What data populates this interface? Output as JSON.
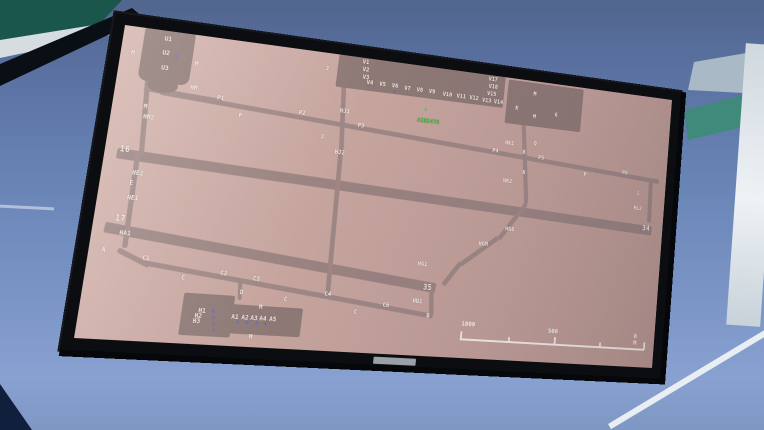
{
  "colors": {
    "screen_background": "#c3a19b",
    "pavement": "#9d8684",
    "apron": "#8d7875",
    "label_text": "#f2eae4",
    "aircraft_blue": "#4a66e8",
    "aircraft_green": "#3cc23c",
    "callsign_green": "#43bd3e",
    "bezel": "#0b0d10",
    "sky_top": "#51658d",
    "sky_bottom": "#88a1d1"
  },
  "display": {
    "kind": "airport ground chart",
    "callsign": "AIB2478",
    "scale_bar": {
      "start": "1000",
      "mid": "500",
      "end": "0 M"
    },
    "runways": [
      "16/34",
      "17/35"
    ],
    "labels": [
      {
        "t": "U1",
        "u": 40,
        "v": 6
      },
      {
        "t": "U2",
        "u": 40,
        "v": 20
      },
      {
        "t": "U3",
        "u": 41,
        "v": 35
      },
      {
        "t": "M",
        "u": 10,
        "v": 24
      },
      {
        "t": "M",
        "u": 73,
        "v": 27
      },
      {
        "t": "HM",
        "u": 72,
        "v": 51
      },
      {
        "t": "P1",
        "u": 100,
        "v": 58
      },
      {
        "t": "P",
        "u": 124,
        "v": 73
      },
      {
        "t": "M",
        "u": 30,
        "v": 75
      },
      {
        "t": "HM2",
        "u": 31,
        "v": 85
      },
      {
        "t": "16",
        "u": 14,
        "v": 117,
        "k": "r"
      },
      {
        "t": "HE2",
        "u": 29,
        "v": 140
      },
      {
        "t": "E",
        "u": 28,
        "v": 150
      },
      {
        "t": "NE1",
        "u": 28,
        "v": 164
      },
      {
        "t": "17",
        "u": 20,
        "v": 183,
        "k": "r"
      },
      {
        "t": "HA1",
        "u": 26,
        "v": 198
      },
      {
        "t": "A",
        "u": 12,
        "v": 215
      },
      {
        "t": "C1",
        "u": 51,
        "v": 220
      },
      {
        "t": "C",
        "u": 91,
        "v": 236
      },
      {
        "t": "C2",
        "u": 128,
        "v": 229
      },
      {
        "t": "C3",
        "u": 161,
        "v": 232
      },
      {
        "t": "D",
        "u": 150,
        "v": 246
      },
      {
        "t": "C",
        "u": 195,
        "v": 250
      },
      {
        "t": "M",
        "u": 171,
        "v": 259
      },
      {
        "t": "H1",
        "u": 112,
        "v": 266
      },
      {
        "t": "H2",
        "u": 109,
        "v": 271
      },
      {
        "t": "H3",
        "u": 108,
        "v": 276
      },
      {
        "t": "A1",
        "u": 145,
        "v": 270
      },
      {
        "t": "A2",
        "u": 155,
        "v": 270
      },
      {
        "t": "A3",
        "u": 164,
        "v": 270
      },
      {
        "t": "A4",
        "u": 173,
        "v": 270
      },
      {
        "t": "A5",
        "u": 183,
        "v": 270
      },
      {
        "t": "M",
        "u": 165,
        "v": 288
      },
      {
        "t": "C4",
        "u": 236,
        "v": 242
      },
      {
        "t": "C",
        "u": 269,
        "v": 258
      },
      {
        "t": "C6",
        "u": 299,
        "v": 249
      },
      {
        "t": "B",
        "u": 348,
        "v": 257
      },
      {
        "t": "HB1",
        "u": 331,
        "v": 243
      },
      {
        "t": "35",
        "u": 341,
        "v": 227,
        "k": "r"
      },
      {
        "t": "HG1",
        "u": 332,
        "v": 205
      },
      {
        "t": "HGM",
        "u": 398,
        "v": 179
      },
      {
        "t": "HG6",
        "u": 427,
        "v": 161
      },
      {
        "t": "HK2",
        "u": 419,
        "v": 110
      },
      {
        "t": "K",
        "u": 441,
        "v": 99
      },
      {
        "t": "P",
        "u": 515,
        "v": 94
      },
      {
        "t": "P6",
        "u": 563,
        "v": 87
      },
      {
        "t": "L",
        "u": 584,
        "v": 108
      },
      {
        "t": "HL2",
        "u": 581,
        "v": 125
      },
      {
        "t": "34",
        "u": 594,
        "v": 145,
        "k": "r"
      },
      {
        "t": "P5",
        "u": 458,
        "v": 81
      },
      {
        "t": "K",
        "u": 439,
        "v": 77
      },
      {
        "t": "HK1",
        "u": 417,
        "v": 69
      },
      {
        "t": "Q",
        "u": 451,
        "v": 66
      },
      {
        "t": "P4",
        "u": 403,
        "v": 79
      },
      {
        "t": "K",
        "u": 425,
        "v": 30
      },
      {
        "t": "M",
        "u": 445,
        "v": 12
      },
      {
        "t": "M",
        "u": 447,
        "v": 37
      },
      {
        "t": "G",
        "u": 473,
        "v": 32
      },
      {
        "t": "J",
        "u": 207,
        "v": 14
      },
      {
        "t": "HJ1",
        "u": 228,
        "v": 56
      },
      {
        "t": "P3",
        "u": 249,
        "v": 69
      },
      {
        "t": "J",
        "u": 211,
        "v": 85
      },
      {
        "t": "HJ2",
        "u": 228,
        "v": 99
      },
      {
        "t": "P2",
        "u": 185,
        "v": 63
      },
      {
        "t": "V1",
        "u": 246,
        "v": 2
      },
      {
        "t": "V2",
        "u": 247,
        "v": 10
      },
      {
        "t": "V3",
        "u": 248,
        "v": 18
      },
      {
        "t": "V4",
        "u": 253,
        "v": 23
      },
      {
        "t": "V5",
        "u": 267,
        "v": 23
      },
      {
        "t": "V6",
        "u": 281,
        "v": 23
      },
      {
        "t": "V7",
        "u": 295,
        "v": 24
      },
      {
        "t": "V8",
        "u": 309,
        "v": 24
      },
      {
        "t": "V9",
        "u": 323,
        "v": 24
      },
      {
        "t": "V10",
        "u": 339,
        "v": 25
      },
      {
        "t": "V11",
        "u": 355,
        "v": 25
      },
      {
        "t": "V12",
        "u": 370,
        "v": 25
      },
      {
        "t": "V13",
        "u": 385,
        "v": 26
      },
      {
        "t": "V14",
        "u": 399,
        "v": 26
      },
      {
        "t": "V17",
        "u": 390,
        "v": 2
      },
      {
        "t": "V18",
        "u": 391,
        "v": 10
      },
      {
        "t": "V15",
        "u": 390,
        "v": 18
      }
    ],
    "aircraft": [
      {
        "u": 52,
        "v": 21,
        "color": "blue",
        "rot": -45
      },
      {
        "u": 283,
        "v": 28,
        "color": "blue",
        "rot": -45
      },
      {
        "u": 320,
        "v": 43,
        "color": "green",
        "rot": -45
      },
      {
        "u": 125,
        "v": 264,
        "color": "blue",
        "rot": -90
      },
      {
        "u": 126,
        "v": 270,
        "color": "blue",
        "rot": -90
      },
      {
        "u": 127,
        "v": 276,
        "color": "blue",
        "rot": -90
      },
      {
        "u": 128,
        "v": 282,
        "color": "blue",
        "rot": -90
      },
      {
        "u": 150,
        "v": 274,
        "color": "blue",
        "rot": 0
      },
      {
        "u": 159,
        "v": 274,
        "color": "blue",
        "rot": 0
      },
      {
        "u": 169,
        "v": 274,
        "color": "blue",
        "rot": 0
      },
      {
        "u": 178,
        "v": 274,
        "color": "blue",
        "rot": 0
      }
    ]
  }
}
